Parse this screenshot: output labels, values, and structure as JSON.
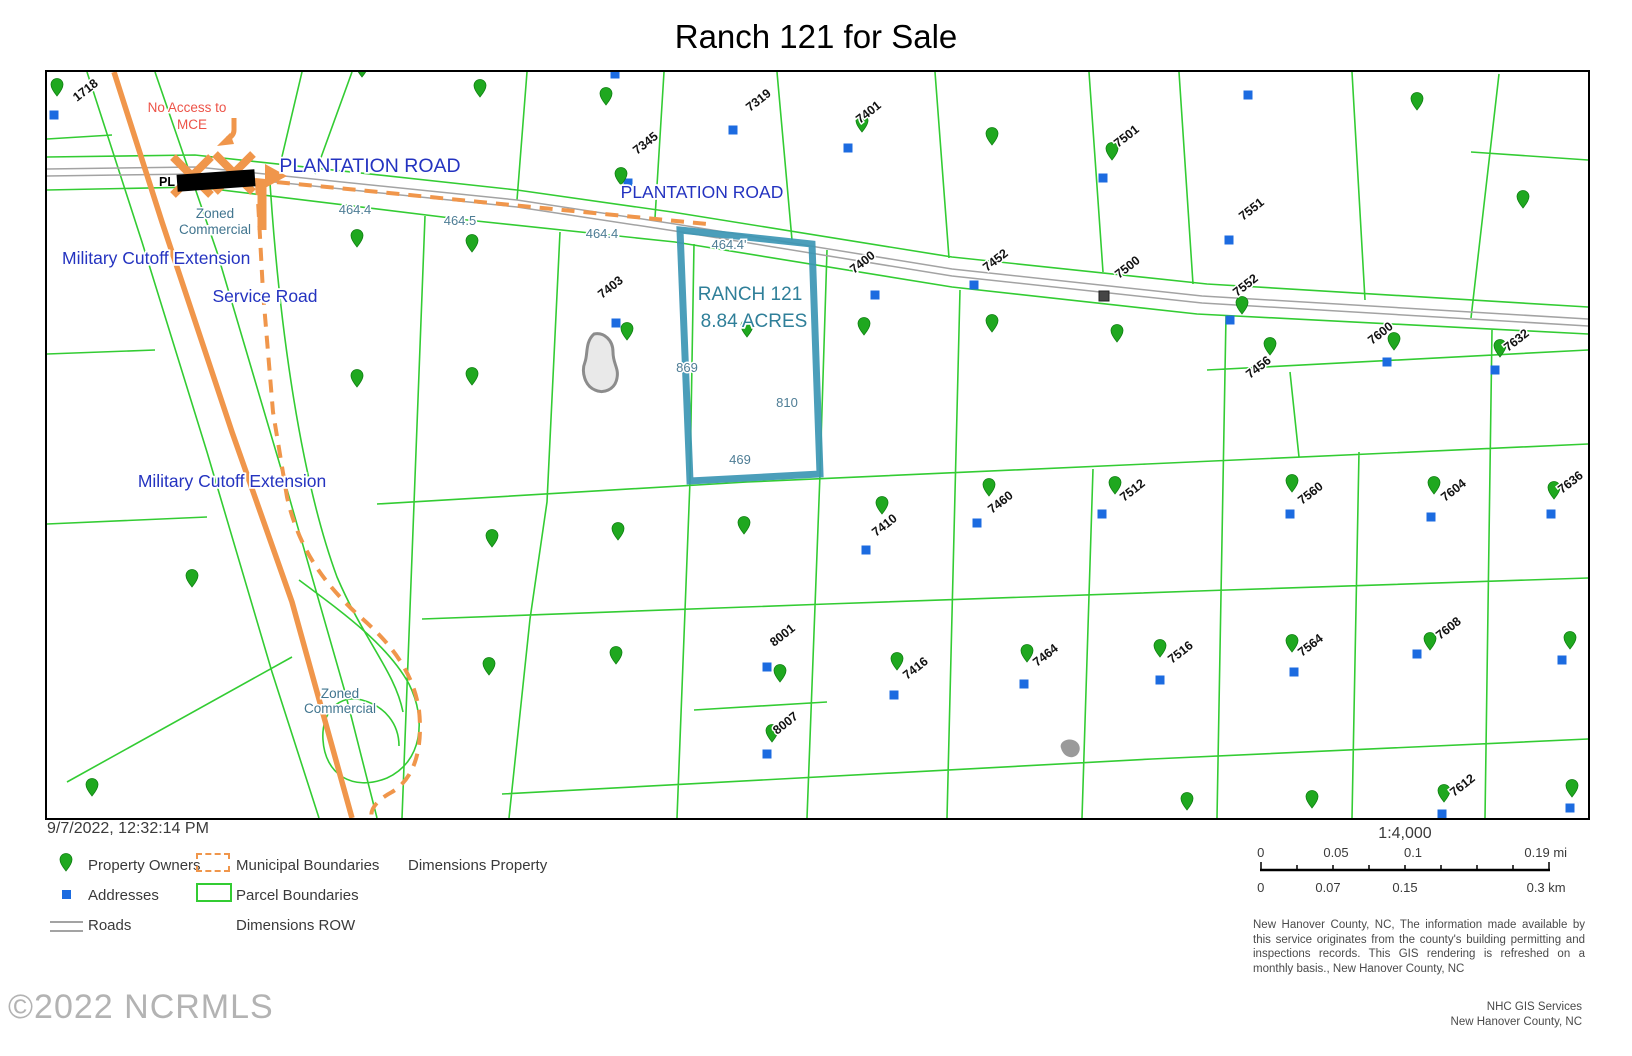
{
  "title": "Ranch 121 for Sale",
  "colors": {
    "parcel_green": "#33CC33",
    "highlight_teal": "#3C96B4",
    "orange": "#F0964B",
    "road_gray": "#A3A3A3",
    "pin_green": "#1FA81F",
    "address_blue": "#1C6BE0",
    "road_label_blue": "#2433C0",
    "dim_label": "#4E7D95",
    "warning_red": "#ED5348"
  },
  "map": {
    "highlight": {
      "name": "RANCH 121",
      "acreage": "8.84 ACRES"
    },
    "road_labels": {
      "plantation_1": "PLANTATION ROAD",
      "plantation_2": "PLANTATION ROAD",
      "military_cutoff_1": "Military Cutoff Extension",
      "military_cutoff_2": "Military Cutoff Extension",
      "service_road": "Service Road",
      "redacted_prefix": "PL"
    },
    "annotations": {
      "no_access_line1": "No Access to",
      "no_access_line2": "MCE",
      "zoned_commercial_line1": "Zoned",
      "zoned_commercial_line2": "Commercial"
    },
    "dim_labels": [
      {
        "t": "464.4",
        "x": 308,
        "y": 142
      },
      {
        "t": "464.5",
        "x": 413,
        "y": 153
      },
      {
        "t": "464.4",
        "x": 555,
        "y": 166
      },
      {
        "t": "464.4'",
        "x": 682,
        "y": 177
      },
      {
        "t": "869",
        "x": 640,
        "y": 300
      },
      {
        "t": "810",
        "x": 740,
        "y": 335
      },
      {
        "t": "469",
        "x": 693,
        "y": 392
      }
    ],
    "parcel_labels": [
      {
        "t": "1718",
        "x": 30,
        "y": 30
      },
      {
        "t": "7345",
        "x": 590,
        "y": 83
      },
      {
        "t": "7319",
        "x": 703,
        "y": 40
      },
      {
        "t": "7401",
        "x": 813,
        "y": 52
      },
      {
        "t": "7501",
        "x": 1071,
        "y": 76
      },
      {
        "t": "7551",
        "x": 1196,
        "y": 149
      },
      {
        "t": "7403",
        "x": 555,
        "y": 227
      },
      {
        "t": "7400",
        "x": 807,
        "y": 202
      },
      {
        "t": "7452",
        "x": 940,
        "y": 200
      },
      {
        "t": "7500",
        "x": 1072,
        "y": 207
      },
      {
        "t": "7552",
        "x": 1190,
        "y": 225
      },
      {
        "t": "7456",
        "x": 1203,
        "y": 307
      },
      {
        "t": "7600",
        "x": 1325,
        "y": 273
      },
      {
        "t": "7632",
        "x": 1461,
        "y": 280
      },
      {
        "t": "7410",
        "x": 829,
        "y": 465
      },
      {
        "t": "7460",
        "x": 945,
        "y": 442
      },
      {
        "t": "7512",
        "x": 1077,
        "y": 430
      },
      {
        "t": "7560",
        "x": 1255,
        "y": 433
      },
      {
        "t": "7604",
        "x": 1398,
        "y": 430
      },
      {
        "t": "7636",
        "x": 1515,
        "y": 422
      },
      {
        "t": "8001",
        "x": 727,
        "y": 575
      },
      {
        "t": "8007",
        "x": 730,
        "y": 663
      },
      {
        "t": "7416",
        "x": 860,
        "y": 608
      },
      {
        "t": "7464",
        "x": 990,
        "y": 595
      },
      {
        "t": "7516",
        "x": 1125,
        "y": 592
      },
      {
        "t": "7564",
        "x": 1255,
        "y": 585
      },
      {
        "t": "7608",
        "x": 1393,
        "y": 568
      },
      {
        "t": "7612",
        "x": 1407,
        "y": 725
      }
    ],
    "markers": {
      "pins": [
        [
          10,
          24
        ],
        [
          315,
          5
        ],
        [
          433,
          25
        ],
        [
          559,
          33
        ],
        [
          574,
          113
        ],
        [
          815,
          60
        ],
        [
          945,
          73
        ],
        [
          1065,
          88
        ],
        [
          1370,
          38
        ],
        [
          1476,
          136
        ],
        [
          310,
          175
        ],
        [
          425,
          180
        ],
        [
          580,
          268
        ],
        [
          700,
          265
        ],
        [
          817,
          263
        ],
        [
          945,
          260
        ],
        [
          1070,
          270
        ],
        [
          1195,
          242
        ],
        [
          1223,
          283
        ],
        [
          1347,
          278
        ],
        [
          1453,
          285
        ],
        [
          310,
          315
        ],
        [
          425,
          313
        ],
        [
          145,
          515
        ],
        [
          445,
          475
        ],
        [
          571,
          468
        ],
        [
          697,
          462
        ],
        [
          835,
          442
        ],
        [
          942,
          424
        ],
        [
          1068,
          422
        ],
        [
          1245,
          420
        ],
        [
          1387,
          422
        ],
        [
          1507,
          427
        ],
        [
          442,
          603
        ],
        [
          569,
          592
        ],
        [
          733,
          610
        ],
        [
          850,
          598
        ],
        [
          980,
          590
        ],
        [
          1113,
          585
        ],
        [
          1245,
          580
        ],
        [
          1383,
          578
        ],
        [
          1523,
          577
        ],
        [
          725,
          670
        ],
        [
          45,
          724
        ],
        [
          1140,
          738
        ],
        [
          1265,
          736
        ],
        [
          1397,
          730
        ],
        [
          1525,
          725
        ]
      ],
      "squares": [
        [
          7,
          43
        ],
        [
          568,
          2
        ],
        [
          1201,
          23
        ],
        [
          581,
          111
        ],
        [
          686,
          58
        ],
        [
          801,
          76
        ],
        [
          1056,
          106
        ],
        [
          1182,
          168
        ],
        [
          569,
          251
        ],
        [
          828,
          223
        ],
        [
          927,
          213
        ],
        [
          1183,
          248
        ],
        [
          1340,
          290
        ],
        [
          1448,
          298
        ],
        [
          819,
          478
        ],
        [
          930,
          451
        ],
        [
          1055,
          442
        ],
        [
          1243,
          442
        ],
        [
          1384,
          445
        ],
        [
          1504,
          442
        ],
        [
          720,
          595
        ],
        [
          847,
          623
        ],
        [
          977,
          612
        ],
        [
          1113,
          608
        ],
        [
          1247,
          600
        ],
        [
          1370,
          582
        ],
        [
          1515,
          588
        ],
        [
          720,
          682
        ],
        [
          1395,
          742
        ],
        [
          1523,
          736
        ]
      ],
      "dark_squares": [
        [
          1057,
          224
        ]
      ]
    }
  },
  "footer": {
    "timestamp": "9/7/2022, 12:32:14 PM",
    "legend": {
      "property_owners": "Property Owners",
      "addresses": "Addresses",
      "roads": "Roads",
      "municipal_boundaries": "Municipal Boundaries",
      "parcel_boundaries": "Parcel Boundaries",
      "dimensions_property": "Dimensions Property",
      "dimensions_row": "Dimensions ROW"
    },
    "scale": {
      "ratio": "1:4,000",
      "mi_ticks": [
        "0",
        "0.05",
        "0.1",
        "0.19 mi"
      ],
      "km_ticks": [
        "0",
        "0.07",
        "0.15",
        "0.3 km"
      ]
    },
    "disclaimer": "New Hanover County, NC, The information made available by this service originates from the county's building permitting and inspections records.  This GIS rendering is refreshed on a monthly basis., New Hanover County, NC",
    "credit_line1": "NHC GIS Services",
    "credit_line2": "New Hanover County, NC",
    "copyright": "©2022 NCRMLS"
  }
}
